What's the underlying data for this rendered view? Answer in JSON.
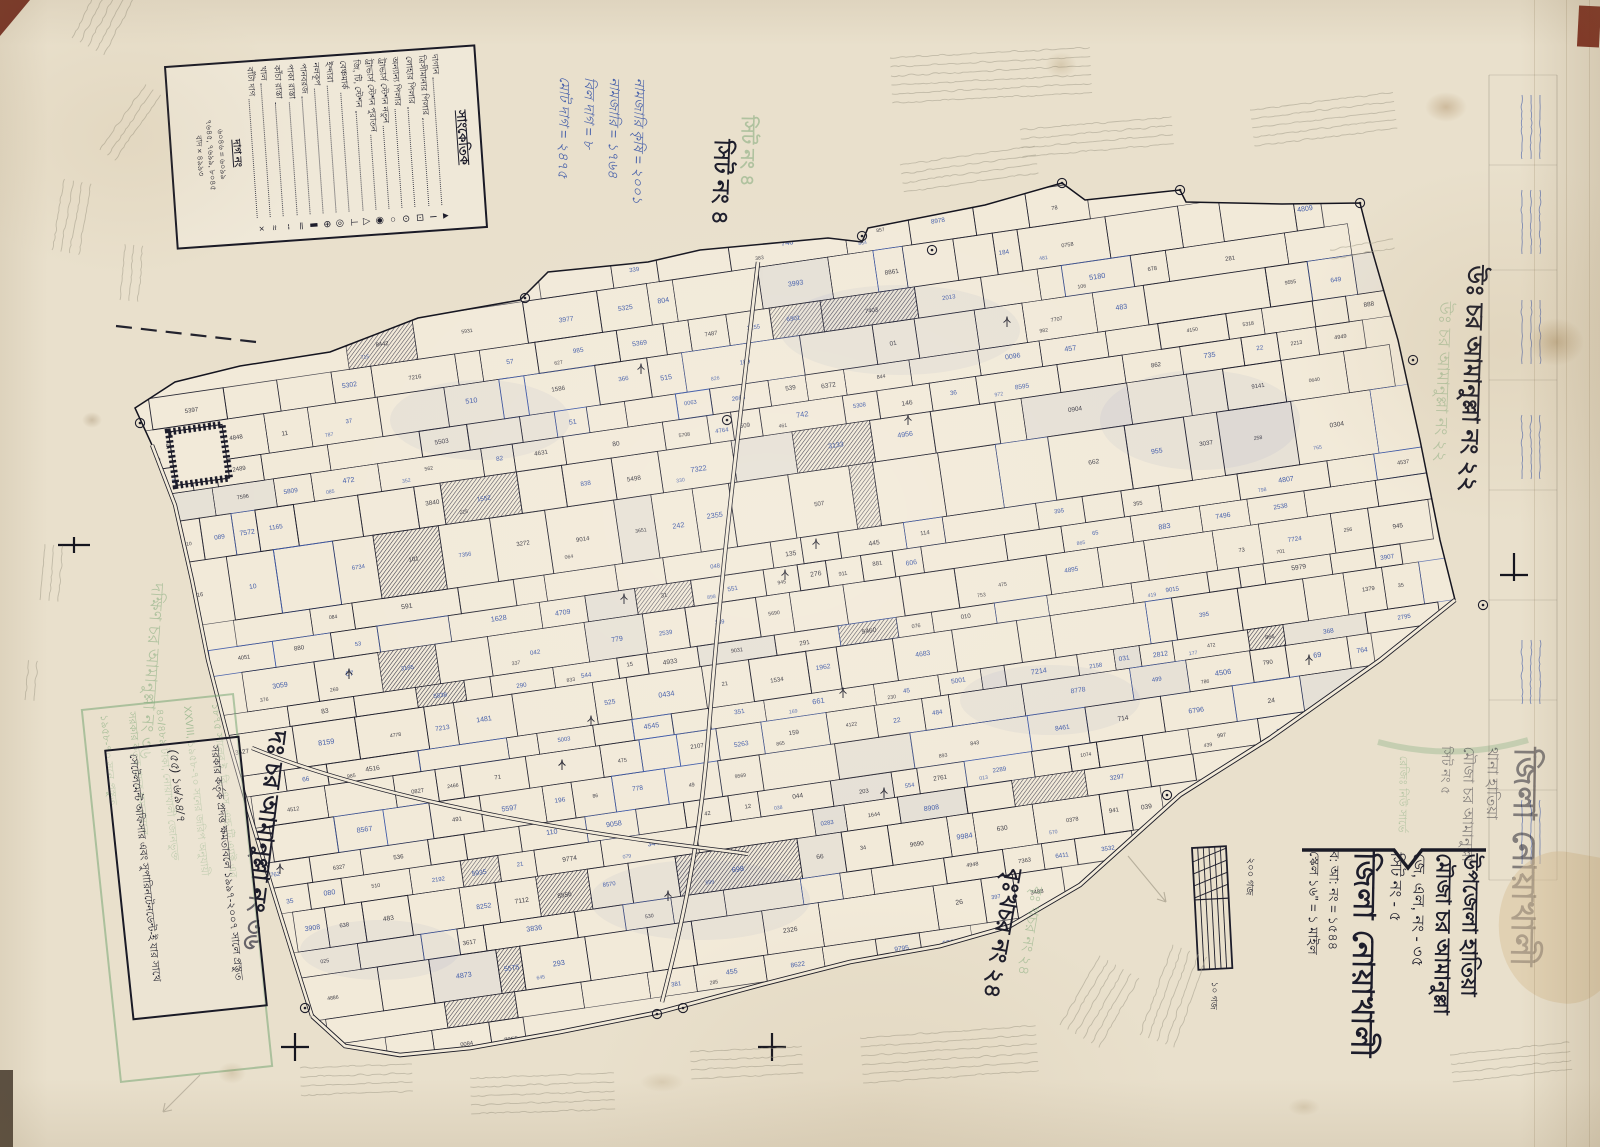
{
  "sheet": {
    "sheet_no_label": "সিট নং ৪",
    "neighbors": {
      "north": "উঃ চর আমানুল্লা নং ২২",
      "north_green": "উঃ চর আমানুল্লা নং ২২",
      "south": "দঃ চর আমানুল্লা নং ৩৬",
      "south_green": "দক্ষিণ চর আমানুল্লা নং ৩৬",
      "southeast": "বৃঃখচর নং ২৪",
      "southeast_green": "বৃঃ খচর নং ২৪"
    }
  },
  "legend": {
    "title": "সাংকেতিক",
    "items": [
      {
        "label": "দাগান",
        "symbol": "▲"
      },
      {
        "label": "ত্রিসীমানার পিলার",
        "symbol": "Ι"
      },
      {
        "label": "লোহার পিলার",
        "symbol": "⊡"
      },
      {
        "label": "অন্যান্য পিলার",
        "symbol": "⊙"
      },
      {
        "label": "ট্রাভার্স স্টেশন নতুন",
        "symbol": "○"
      },
      {
        "label": "ট্রাভার্স স্টেশন পুরাতন",
        "symbol": "◉"
      },
      {
        "label": "জি, টি, স্টেশন",
        "symbol": "△"
      },
      {
        "label": "বেঞ্চমার্ক",
        "symbol": "⊥"
      },
      {
        "label": "ইন্দারা",
        "symbol": "◎"
      },
      {
        "label": "নলকূপ",
        "symbol": "⊕"
      },
      {
        "label": "পানবরজ",
        "symbol": "▮"
      },
      {
        "label": "পাকা রাস্তা",
        "symbol": "═"
      },
      {
        "label": "কাঁচা রাস্তা",
        "symbol": "╌"
      },
      {
        "label": "খাল",
        "symbol": "≈"
      },
      {
        "label": "বাঁটা দাগ",
        "symbol": "×"
      }
    ],
    "dag_section": {
      "title": "দাগ নং",
      "lines": [
        "৬০৪৬ = ৬০৯৯",
        "৭৬৪৫, ৭৬৯৯, ৮০৪৫",
        "বাদ × ৪৯৯৩"
      ]
    }
  },
  "title_block": {
    "lines": [
      {
        "text": "উপজেলা হাতিয়া",
        "cls": "t-lg"
      },
      {
        "text": "মৌজা চর আমানুল্লা",
        "cls": "t-lg"
      },
      {
        "text": "জে, এল, নং - ৩৫",
        "cls": "t-md"
      },
      {
        "text": "সিট নং - ৫",
        "cls": "t-md"
      },
      {
        "text": "জিলা নোয়াখালী",
        "cls": "t-xl"
      },
      {
        "text": "ব: আ: নং = ১৫৪৪",
        "cls": "t-sm"
      },
      {
        "text": "স্কেল ১৬\" = ১ মাইল",
        "cls": "t-sm"
      }
    ]
  },
  "green_stamp": {
    "title_lines": [
      {
        "text": "জিলা নোয়াখালী",
        "cls": "g-xl"
      },
      {
        "text": "থানা হাতিয়া",
        "cls": "g-md"
      },
      {
        "text": "মৌজা চর আমানুল্লা",
        "cls": "g-md"
      },
      {
        "text": "সিট নং ৫",
        "cls": "g-sm"
      }
    ],
    "side_note": "রেজিঃ নিউ সার্ভে",
    "box_lines": [
      "১৮৭৫ সালের ই. বি. এস. এন্ড টি এ্যাক্ট এর",
      "XXVIII, ১৯৫৮-৭০ সনের জরিপ অনুযায়ী",
      "৪০/৪৮৯ টাকা, নোয়াখালী জোনভুক্ত",
      "সরকার কর্তৃক প্রদত্ত ক্ষমতাবলে",
      "১৯৫৮-৭০ সনে প্রস্তুত"
    ]
  },
  "stamp_box": {
    "lines": [
      "সরকার কর্তৃক প্রদত্ত ক্ষমতাবলে ১৯৯৭-২০০৭ সালে প্রস্তুত",
      "(৫৫) ১৬/৯৪/৭",
      "সেটেলমেন্ট অফিসার এবং সুপারিনটেনডেন্ট-ই যার সাথে"
    ]
  },
  "notes": {
    "blue_lines": [
      "নামজারি কৃষি = ২০০১",
      "নামজারি = ১৭৬৪",
      "বিল দাগ = ৮",
      "মোট দাগ = ২৪৭৫"
    ]
  },
  "scale_bar": {
    "note_top": "২০০ গজ",
    "note_bottom": "১০ গজ"
  },
  "colors": {
    "ink": "#1d1d2b",
    "blue": "#3b57a8",
    "green": "#8fb58a",
    "pencil": "#a19a88",
    "paper": "#e9e0cc",
    "map_fill": "#f2ead9"
  },
  "map": {
    "rotation_deg": -8.3,
    "parcel_digits": "0123456789",
    "outline": [
      [
        135,
        408
      ],
      [
        175,
        382
      ],
      [
        240,
        366
      ],
      [
        330,
        352
      ],
      [
        418,
        318
      ],
      [
        520,
        300
      ],
      [
        548,
        272
      ],
      [
        648,
        262
      ],
      [
        700,
        250
      ],
      [
        828,
        238
      ],
      [
        862,
        242
      ],
      [
        868,
        228
      ],
      [
        985,
        205
      ],
      [
        1062,
        183
      ],
      [
        1085,
        200
      ],
      [
        1180,
        190
      ],
      [
        1186,
        202
      ],
      [
        1282,
        204
      ],
      [
        1360,
        203
      ],
      [
        1372,
        250
      ],
      [
        1398,
        340
      ],
      [
        1420,
        440
      ],
      [
        1440,
        540
      ],
      [
        1455,
        600
      ],
      [
        1380,
        660
      ],
      [
        1270,
        738
      ],
      [
        1180,
        795
      ],
      [
        1080,
        885
      ],
      [
        1010,
        926
      ],
      [
        940,
        946
      ],
      [
        850,
        962
      ],
      [
        760,
        985
      ],
      [
        660,
        1012
      ],
      [
        560,
        1032
      ],
      [
        470,
        1048
      ],
      [
        400,
        1055
      ],
      [
        345,
        1046
      ],
      [
        312,
        1016
      ],
      [
        295,
        962
      ],
      [
        272,
        888
      ],
      [
        250,
        815
      ],
      [
        228,
        738
      ],
      [
        208,
        660
      ],
      [
        192,
        580
      ],
      [
        175,
        505
      ],
      [
        152,
        445
      ]
    ]
  }
}
